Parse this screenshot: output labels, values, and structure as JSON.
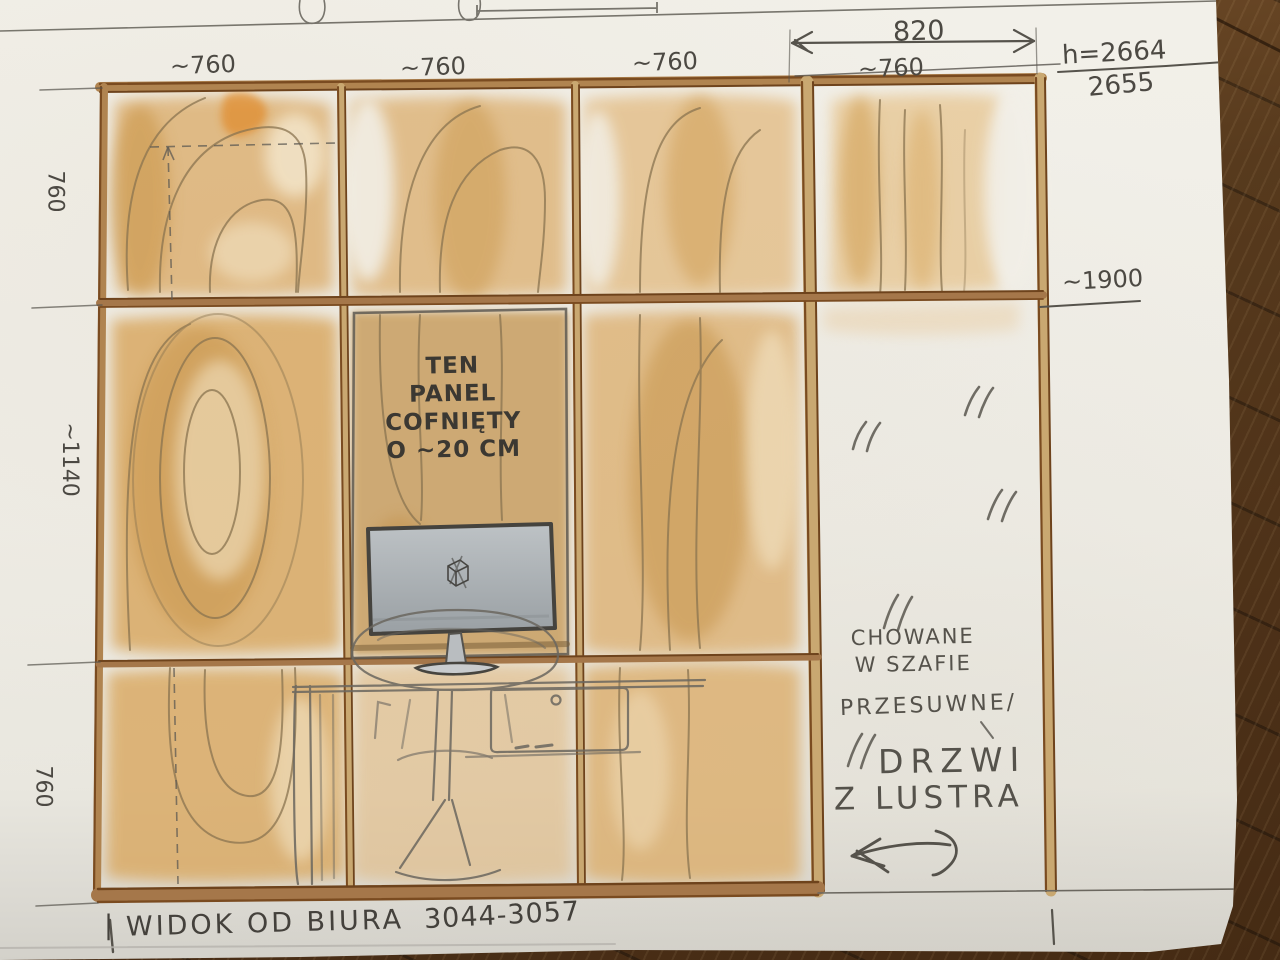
{
  "palette": {
    "paper": "#efede6",
    "wood_wash": "#dcae6e",
    "frame_brown": "#8f5a28",
    "pencil_gray": "#55524c",
    "floor_wood": "#563819",
    "monitor_screen": "#b3b8bc"
  },
  "dimensions": {
    "top": [
      "~760",
      "~760",
      "~760",
      "~760"
    ],
    "right_width": "820",
    "height_primary": "h=2664",
    "height_secondary": "2655",
    "shelf_height": "~1900",
    "left": [
      "760",
      "~1140",
      "760"
    ]
  },
  "notes": {
    "panel": [
      "TEN",
      "PANEL",
      "COFNIĘTY",
      "O ~20 CM"
    ],
    "hidden": [
      "CHOWANE",
      "W SZAFIE"
    ],
    "sliding": "PRZESUWNE/",
    "doors": [
      "DRZWI",
      "Z LUSTRA"
    ]
  },
  "footer": {
    "tick_left": "|",
    "caption": "WIDOK OD BIURA",
    "code": "3044-3057",
    "tick_right": "|"
  }
}
